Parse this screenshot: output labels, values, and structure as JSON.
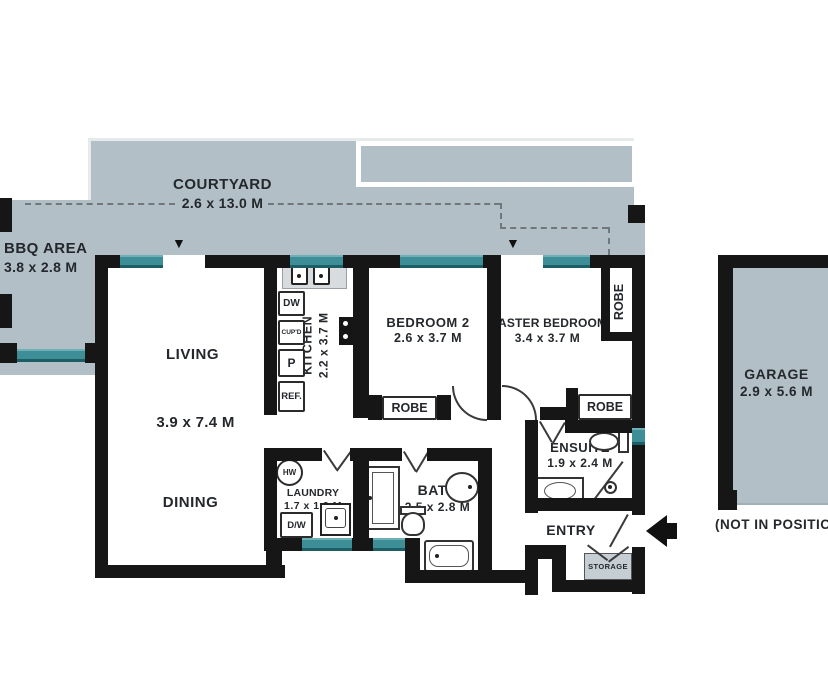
{
  "title": "Apartment floor plan",
  "areas": {
    "courtyard": {
      "label": "COURTYARD",
      "dims": "2.6 x 13.0 M"
    },
    "bbq": {
      "label": "BBQ AREA",
      "dims": "3.8 x 2.8 M"
    },
    "living": {
      "label": "LIVING"
    },
    "living_dining_dims": "3.9 x 7.4 M",
    "dining": {
      "label": "DINING"
    },
    "kitchen": {
      "label": "KITCHEN",
      "dims": "2.2 x 3.7 M"
    },
    "bedroom2": {
      "label": "BEDROOM 2",
      "dims": "2.6 x 3.7 M"
    },
    "master_bedroom": {
      "label": "MASTER BEDROOM",
      "dims": "3.4 x 3.7 M"
    },
    "ensuite": {
      "label": "ENSUITE",
      "dims": "1.9 x 2.4 M"
    },
    "bath": {
      "label": "BATH",
      "dims": "2.5 x 2.8 M"
    },
    "laundry": {
      "label": "LAUNDRY",
      "dims": "1.7 x 1.9 M"
    },
    "entry": {
      "label": "ENTRY"
    },
    "storage": {
      "label": "STORAGE"
    },
    "garage": {
      "label": "GARAGE",
      "dims": "2.9 x 5.6 M",
      "note": "(NOT IN POSITION)"
    }
  },
  "wardrobes": {
    "bedroom2": "ROBE",
    "master_side": "ROBE",
    "master_rear": "ROBE"
  },
  "fixtures": {
    "hot_water": "HW",
    "kitchen_dishwasher": "DW",
    "cupboard": "CUP'D",
    "pantry": "P",
    "fridge": "REF.",
    "laundry_dishwasher": "D/W"
  },
  "colors": {
    "outdoor_fill": "#b2bfc7",
    "wall": "#161616",
    "window": "#3d8e97",
    "storage_fill": "#c4ced3",
    "text": "#24282c"
  }
}
